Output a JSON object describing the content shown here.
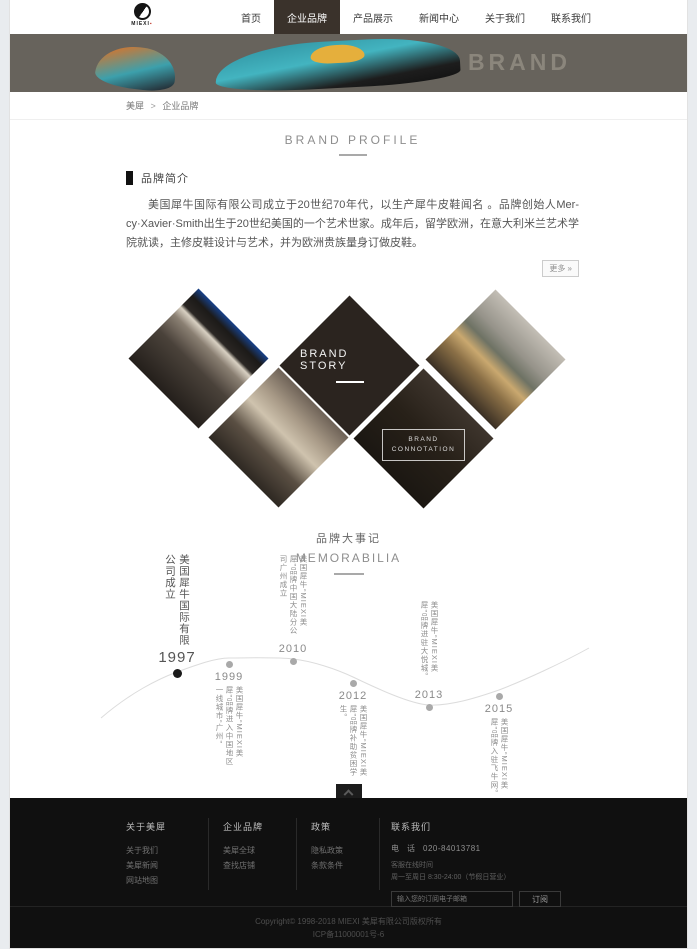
{
  "header": {
    "logo_text": "MIEXI",
    "nav": [
      {
        "label": "首页",
        "active": false
      },
      {
        "label": "企业品牌",
        "active": true
      },
      {
        "label": "产品展示",
        "active": false
      },
      {
        "label": "新闻中心",
        "active": false
      },
      {
        "label": "关于我们",
        "active": false
      },
      {
        "label": "联系我们",
        "active": false
      }
    ]
  },
  "banner": {
    "title": "BRAND"
  },
  "breadcrumb": {
    "home": "美犀",
    "separator": ">",
    "current": "企业品牌"
  },
  "profile": {
    "section_title": "BRAND PROFILE",
    "subsection": "品牌简介",
    "paragraph": "美国犀牛国际有限公司成立于20世纪70年代，以生产犀牛皮鞋闻名 。品牌创始人Mer-cy·Xavier·Smith出生于20世纪美国的一个艺术世家。成年后，留学欧洲，在意大利米兰艺术学院就读，主修皮鞋设计与艺术，并为欧洲贵族量身订做皮鞋。",
    "more_label": "更多 »"
  },
  "gallery": {
    "center_title": "BRAND STORY",
    "connotation_line1": "BRAND",
    "connotation_line2": "CONNOTATION",
    "images": [
      "storefront-photo",
      "store-interior-photo",
      "rhino-statue-photo",
      "store-display-photo"
    ]
  },
  "memorabilia": {
    "title_cn": "品牌大事记",
    "title_en": "MEMORABILIA",
    "events": [
      {
        "year": "1997",
        "text": "美国犀牛国际有限公司成立",
        "position": "above"
      },
      {
        "year": "1999",
        "text": "美国犀牛“MIEXI美犀”品牌进入中国地区一线城市“广州”",
        "position": "below"
      },
      {
        "year": "2010",
        "text": "美国犀牛“MIEXI美犀”品牌中国大陆分公司广州成立",
        "position": "above"
      },
      {
        "year": "2012",
        "text": "美国犀牛“MIEXI美犀”品牌补助贫困学生。",
        "position": "below"
      },
      {
        "year": "2013",
        "text": "美国犀牛“MIEXI美犀”品牌进驻大悦城。",
        "position": "above"
      },
      {
        "year": "2015",
        "text": "美国犀牛“MIEXI美犀”品牌入驻飞牛网。",
        "position": "below"
      }
    ]
  },
  "footer": {
    "columns": [
      {
        "title": "关于美犀",
        "links": [
          "关于我们",
          "美犀新闻",
          "网站地图"
        ]
      },
      {
        "title": "企业品牌",
        "links": [
          "美犀全球",
          "查找店铺"
        ]
      },
      {
        "title": "政策",
        "links": [
          "隐私政策",
          "条款条件"
        ]
      }
    ],
    "contact": {
      "title": "联系我们",
      "phone_label": "电　话",
      "phone": "020-84013781",
      "service_label": "客服在线时间",
      "service_hours": "周一至周日 8:30-24:00（节假日营业）",
      "subscribe_placeholder": "输入您的订阅电子邮箱",
      "subscribe_button": "订阅"
    },
    "copyright_line1": "Copyright© 1998-2018 MIEXI 美犀有限公司版权所有",
    "copyright_line2": "ICP备11000001号-6"
  },
  "colors": {
    "nav_active_bg": "#3a322b",
    "banner_bg": "#67635c",
    "footer_bg": "#101010",
    "diamond_dark": "#2b241f",
    "logo_accent": "#c0392b"
  }
}
